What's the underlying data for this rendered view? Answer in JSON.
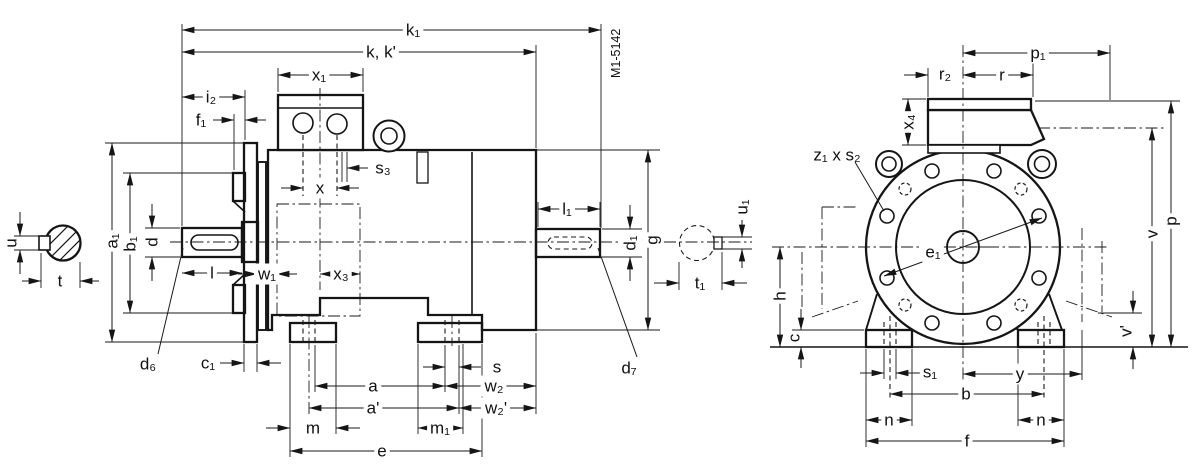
{
  "drawing": {
    "doc_number": "M1-5142",
    "side_view": {
      "labels": {
        "k1": "k₁",
        "kk": "k, k'",
        "x1": "x₁",
        "i2": "i₂",
        "f1": "f₁",
        "s3": "s₃",
        "x": "x",
        "l": "l",
        "w1": "w₁",
        "x3": "x₃",
        "a1": "a₁",
        "b1": "b₁",
        "d": "d",
        "u": "u",
        "t": "t",
        "d6": "d₆",
        "c1": "c₁",
        "s": "s",
        "a": "a",
        "aP": "a'",
        "w2": "w₂",
        "w2P": "w₂'",
        "m": "m",
        "m1": "m₁",
        "e": "e",
        "l1": "l₁",
        "d1": "d₁",
        "g": "g",
        "u1": "u₁",
        "t1": "t₁",
        "d7": "d₇"
      }
    },
    "front_view": {
      "labels": {
        "p1": "p₁",
        "r2": "r₂",
        "r": "r",
        "x4": "x₄",
        "z1s2": "z₁ x s₂",
        "e1": "e₁",
        "h": "h",
        "c": "c",
        "s1": "s₁",
        "y": "y",
        "b": "b",
        "n": "n",
        "f": "f",
        "v": "v",
        "vP": "v'",
        "p": "p"
      }
    }
  }
}
